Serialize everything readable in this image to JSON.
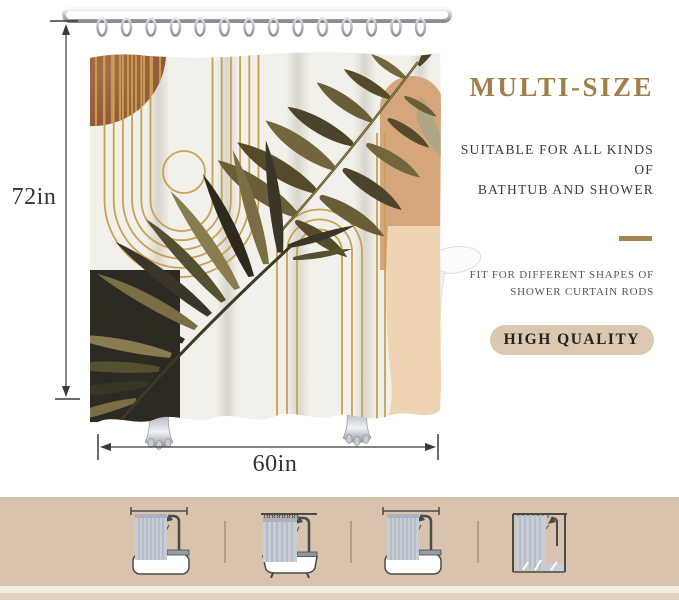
{
  "product": {
    "type_label": "boho abstract shower curtain with monstera and palm leaves on rod over clawfoot bathtub"
  },
  "dimensions": {
    "height_label": "72in",
    "width_label": "60in"
  },
  "marketing": {
    "headline": "MULTI-SIZE",
    "subline1": "SUITABLE FOR ALL KINDS OF",
    "subline2": "BATHTUB AND SHOWER",
    "fit_line1": "FIT FOR DIFFERENT SHAPES OF",
    "fit_line2": "SHOWER CURTAIN RODS",
    "badge": "HIGH QUALITY"
  },
  "footer": {
    "pictograms": [
      {
        "name": "straight-rod-over-bathtub-icon"
      },
      {
        "name": "curved-rod-over-clawfoot-tub-icon"
      },
      {
        "name": "straight-rod-with-shower-over-bathtub-icon"
      },
      {
        "name": "shower-stall-frame-icon"
      }
    ]
  },
  "colors": {
    "headline-gold": "#a08048",
    "accent-gold": "#a5834e",
    "text-dark": "#3b3b3b",
    "text-gray": "#555555",
    "badge-bg": "#dcc7b1",
    "badge-text": "#222222",
    "strip-bg": "#d9c3ae",
    "dim-text": "#333333",
    "terracotta": "#9a5c3e",
    "curtain-cream": "#f2f0ea",
    "leaf-olive": "#6a5e38",
    "peach": "#eed4b2"
  }
}
